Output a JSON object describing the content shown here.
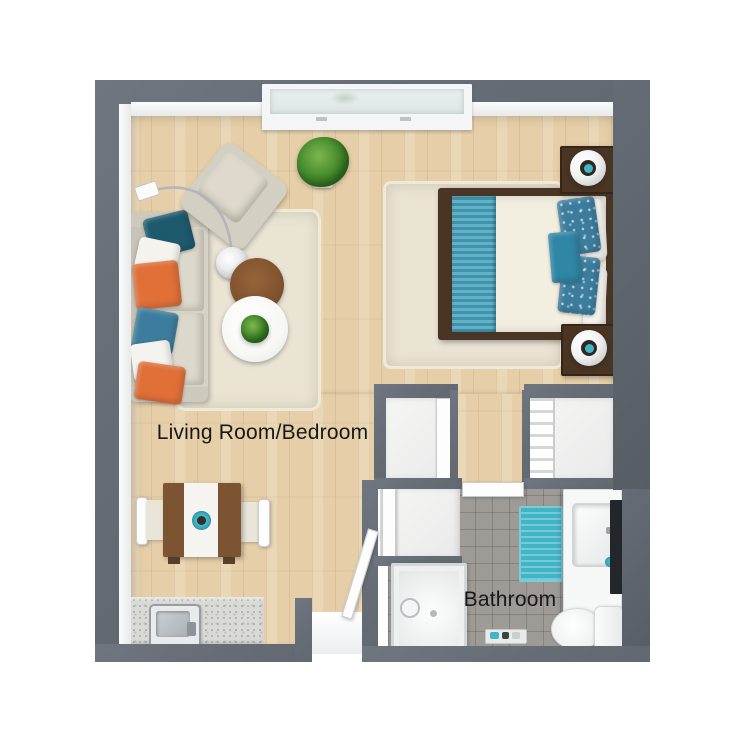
{
  "image_type": "3d-floor-plan-render",
  "labels": {
    "living_room": "Living Room/Bedroom",
    "bathroom": "Bathroom"
  },
  "palette": {
    "wall_gray": "#696f78",
    "wood_floor": "#e6cfa8",
    "tile_gray": "#9e9b97",
    "rug_beige": "#eae4d4",
    "accent_teal": "#41b4c6",
    "accent_dark_teal": "#1e5a6e",
    "accent_blue": "#3c7d9d",
    "accent_orange": "#e06f38",
    "bed_runner_teal": "#55a7bd",
    "wood_dark": "#4a3423",
    "wood_mid": "#7d5431",
    "fixture_white": "#f6f7f7"
  },
  "rooms": [
    {
      "name": "Living Room/Bedroom",
      "furniture": [
        "window",
        "sofa",
        "throw-pillows",
        "arc-floor-lamp",
        "armchair",
        "potted-plant",
        "round-coffee-table-wood",
        "round-coffee-table-white",
        "table-plant",
        "area-rug",
        "dining-table-for-two",
        "queen-bed",
        "bed-rug",
        "nightstand-with-lamp",
        "nightstand-with-lamp",
        "kitchenette-counter-sink",
        "entry-door",
        "closet",
        "closet",
        "closet"
      ]
    },
    {
      "name": "Bathroom",
      "furniture": [
        "walk-in-shower",
        "vanity-sink",
        "wall-mirror",
        "toilet",
        "bath-mat",
        "accessory-tray",
        "bathroom-door"
      ]
    }
  ]
}
